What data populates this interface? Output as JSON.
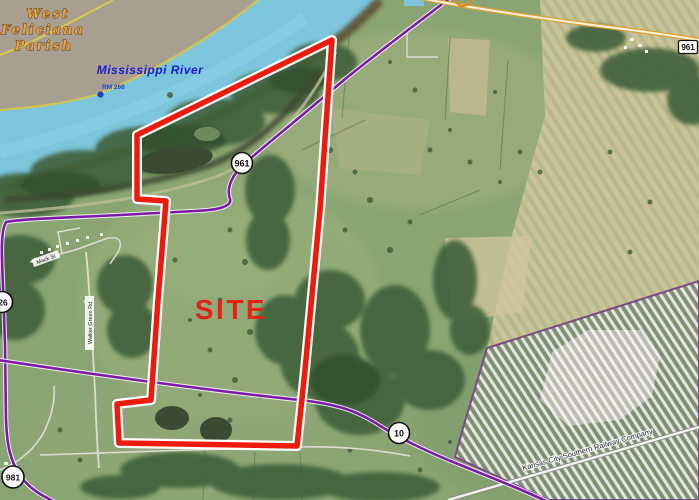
{
  "map": {
    "labels": {
      "parish": {
        "line1": "West",
        "line2": "Feliciana",
        "line3": "Parish"
      },
      "river": "Mississippi River",
      "river_mile": "RM 266",
      "site": "SITE",
      "railway": "Kansas City Southern Railway Company",
      "road_mack": "Mack St",
      "road_walker": "Walker Green Rd"
    },
    "shields": {
      "la961_circle": "961",
      "la961_box": "961",
      "la10_circle": "10",
      "left_edge_circle": "26",
      "bottom_left_circle": "981"
    },
    "colors": {
      "river": "#7cc5dd",
      "boundary_red": "#ee1b0c",
      "highway_purple": "#7d1ba8",
      "site_text": "#e2231a",
      "parish_text": "#eda13c",
      "river_text": "#1b1bd0"
    }
  }
}
